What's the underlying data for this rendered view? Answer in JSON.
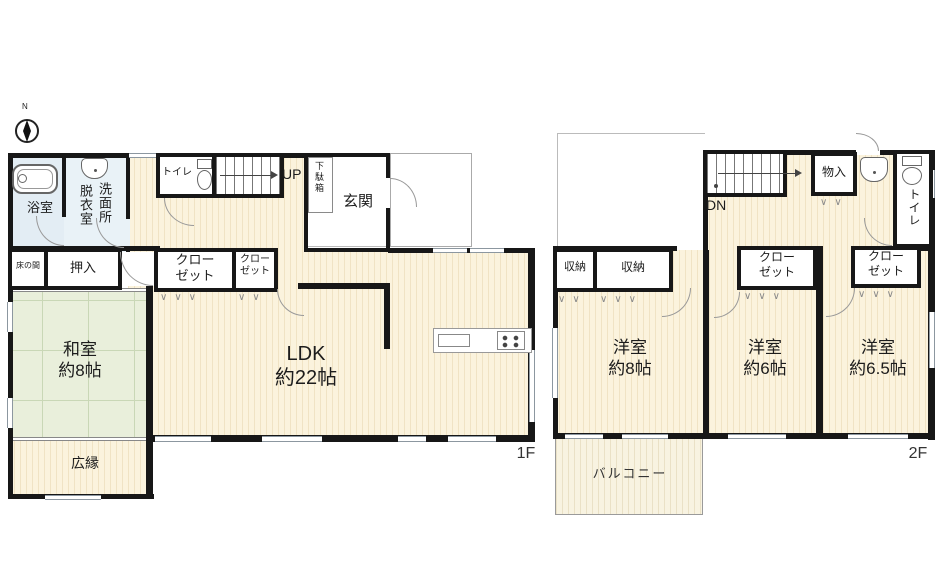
{
  "compass": {
    "north_label": "N"
  },
  "floor1": {
    "floor_label": "1F",
    "rooms": {
      "bathroom": "浴室",
      "dressing_room_col_left": "脱衣室",
      "dressing_room_col_right": "洗面所",
      "toilet": "トイレ",
      "stairs_direction": "UP",
      "shoe_cabinet": "下駄箱",
      "entrance": "玄関",
      "tokonoma": "床の間",
      "oshiire": "押入",
      "closet_large": "クロー\nゼット",
      "closet_small": "クロー\nゼット",
      "japanese_room": "和室\n約8帖",
      "ldk": "LDK\n約22帖",
      "veranda": "広縁"
    }
  },
  "floor2": {
    "floor_label": "2F",
    "rooms": {
      "stairs_direction": "DN",
      "storage_small": "物入",
      "toilet": "トイレ",
      "storage_a": "収納",
      "storage_b": "収納",
      "closet_center": "クロー\nゼット",
      "closet_east": "クロー\nゼット",
      "bedroom_8": "洋室\n約8帖",
      "bedroom_6": "洋室\n約6帖",
      "bedroom_6_5": "洋室\n約6.5帖",
      "balcony": "バルコニー"
    }
  },
  "markers": {
    "folding_door_3": "∨∨∨",
    "folding_door_2": "∨∨"
  },
  "icons": [
    "compass-north-icon",
    "bathtub-icon",
    "washbasin-icon",
    "toilet-icon",
    "kitchen-sink-icon",
    "stove-icon",
    "stair-arrow-icon"
  ],
  "colors": {
    "wall": "#171717",
    "wood_floor": "#fbf3dd",
    "tatami": "#e9efdb",
    "bathroom_blue": "#e3edf4",
    "balcony": "#f8f3e1",
    "door_arc_gray": "#999999"
  }
}
